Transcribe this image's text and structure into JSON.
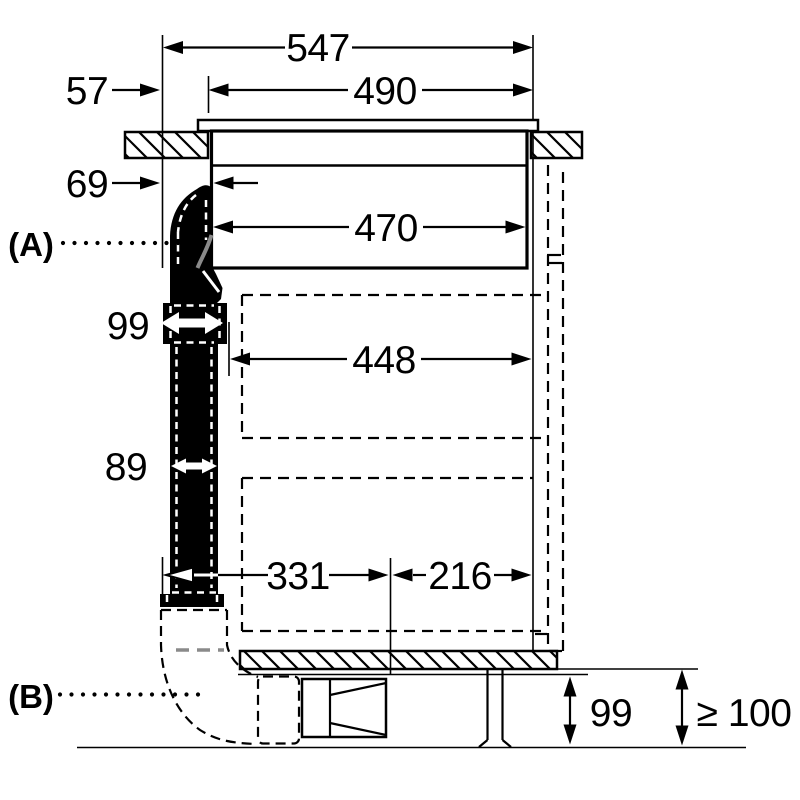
{
  "meta": {
    "type": "installation-diagram",
    "view": "side-cross-section"
  },
  "colors": {
    "line": "#000000",
    "background": "#ffffff",
    "duct_fill": "#000000",
    "shade_gray": "#8a8a8a"
  },
  "callouts": {
    "a": "(A)",
    "b": "(B)"
  },
  "dims": {
    "total_depth": "547",
    "edge_to_cutout": "57",
    "cutout_depth": "490",
    "edge_to_body": "69",
    "body_depth": "470",
    "clearance_depth": "448",
    "duct_width_top": "99",
    "duct_width": "89",
    "duct_to_center": "331",
    "center_to_back": "216",
    "plinth_height": "99",
    "min_clearance": "≥ 100"
  }
}
